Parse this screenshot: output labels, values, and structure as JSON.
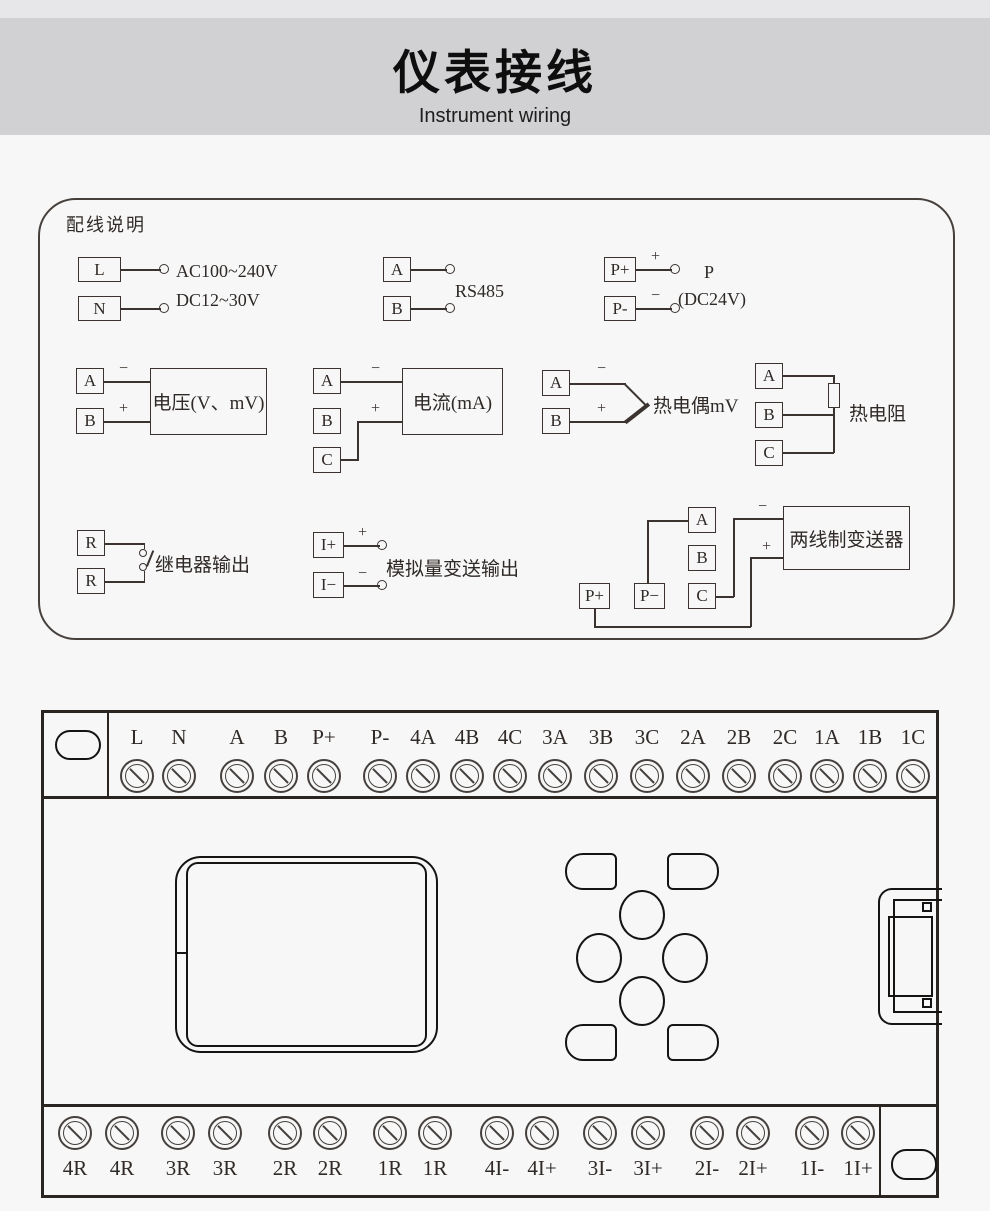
{
  "header": {
    "title": "仪表接线",
    "subtitle": "Instrument wiring"
  },
  "wiring_box": {
    "title": "配线说明",
    "power": {
      "t1": "L",
      "t2": "N",
      "line1": "AC100~240V",
      "line2": "DC12~30V"
    },
    "rs485": {
      "t1": "A",
      "t2": "B",
      "label": "RS485"
    },
    "aux_power": {
      "t1": "P+",
      "t2": "P-",
      "plus": "+",
      "minus": "−",
      "label1": "P",
      "label2": "(DC24V)"
    },
    "voltage": {
      "t1": "A",
      "t2": "B",
      "minus": "−",
      "plus": "+",
      "label": "电压(V、mV)"
    },
    "current": {
      "t1": "A",
      "t2": "B",
      "t3": "C",
      "minus": "−",
      "plus": "+",
      "label": "电流(mA)"
    },
    "thermocouple": {
      "t1": "A",
      "t2": "B",
      "minus": "−",
      "plus": "+",
      "label": "热电偶mV"
    },
    "rtd": {
      "t1": "A",
      "t2": "B",
      "t3": "C",
      "label": "热电阻"
    },
    "relay": {
      "t1": "R",
      "t2": "R",
      "label": "继电器输出"
    },
    "analog_out": {
      "t1": "I+",
      "t2": "I−",
      "plus": "+",
      "minus": "−",
      "label": "模拟量变送输出"
    },
    "transmitter": {
      "t1": "A",
      "t2": "B",
      "t3": "C",
      "t4": "P+",
      "t5": "P−",
      "minus": "−",
      "plus": "+",
      "label": "两线制变送器"
    }
  },
  "terminal_panel": {
    "top_labels": [
      "L",
      "N",
      "A",
      "B",
      "P+",
      "P-",
      "4A",
      "4B",
      "4C",
      "3A",
      "3B",
      "3C",
      "2A",
      "2B",
      "2C",
      "1A",
      "1B",
      "1C"
    ],
    "bottom_labels": [
      "4R",
      "4R",
      "3R",
      "3R",
      "2R",
      "2R",
      "1R",
      "1R",
      "4I-",
      "4I+",
      "3I-",
      "3I+",
      "2I-",
      "2I+",
      "1I-",
      "1I+"
    ]
  },
  "colors": {
    "line": "#3b3330",
    "panel_border": "#2b2522",
    "header_band": "#d1d0d2",
    "top_band": "#e7e7e9",
    "page_bg": "#f7f7f7"
  }
}
